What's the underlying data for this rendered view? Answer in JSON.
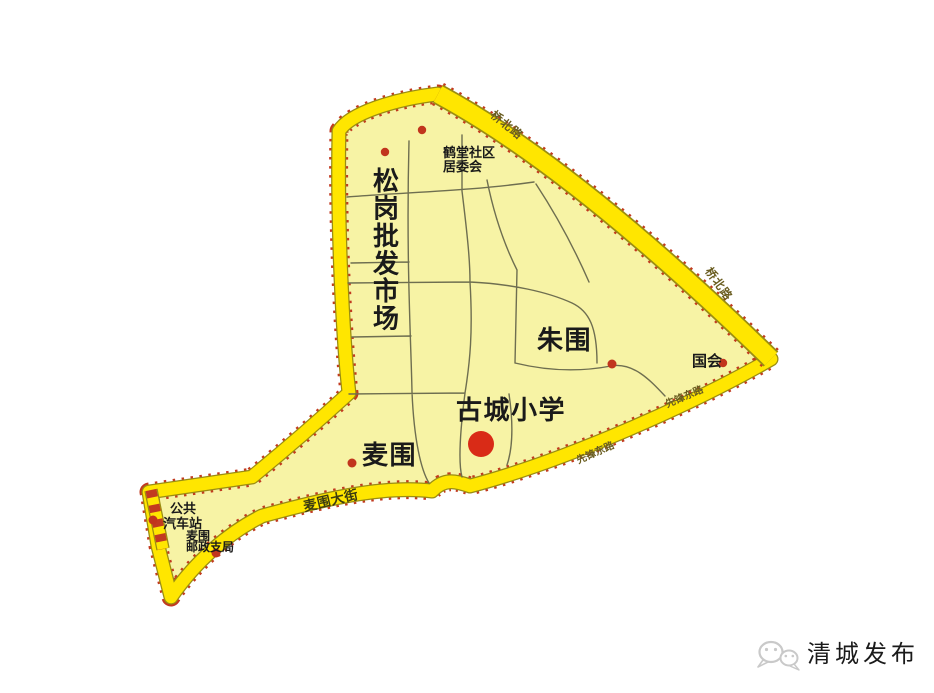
{
  "map": {
    "places": {
      "songgang_market": "松岗批发市场",
      "hetang_committee_line1": "鹤堂社区",
      "hetang_committee_line2": "居委会",
      "zhuwei": "朱围",
      "gucheng_school": "古城小学",
      "maiwei": "麦围",
      "guohui": "国会",
      "bus_station_line1": "公共",
      "bus_station_line2": "汽车站",
      "post_office_line1": "麦围",
      "post_office_line2": "邮政支局"
    },
    "roads": {
      "maiwei_street": "麦围大街",
      "ne_boundary_top": "桥北路",
      "ne_boundary_right": "桥北路",
      "se_boundary_upper": "先锋东路",
      "se_boundary_lower": "先锋东路"
    },
    "colors": {
      "territory_fill": "#F7F3A5",
      "road_yellow": "#FFE600",
      "boundary_dot_red": "#C23A20",
      "poi_red": "#C1351D",
      "school_dot_red": "#D92B17",
      "road_line_olive": "#6E6E50",
      "watermark_gray": "#C9C9C9"
    }
  },
  "watermark": {
    "text": "清城发布"
  }
}
